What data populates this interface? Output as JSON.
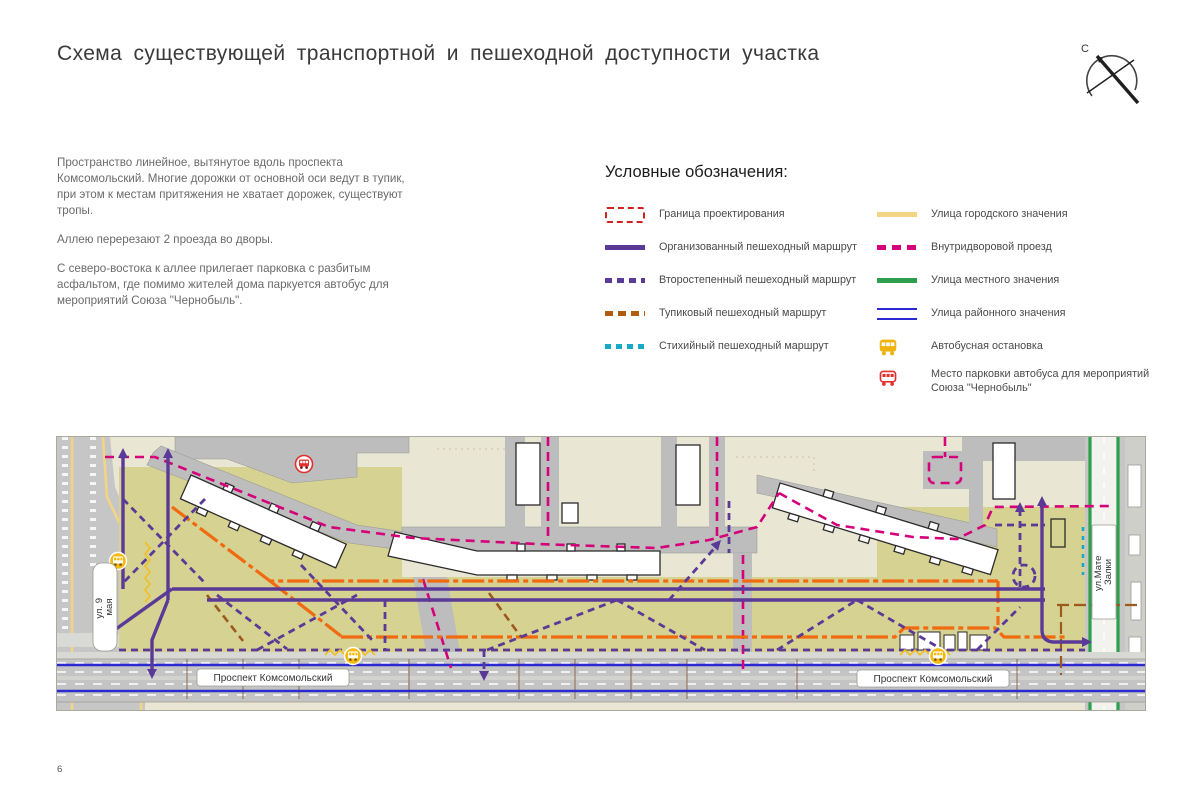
{
  "page": {
    "title": "Схема существующей  транспортной  и пешеходной доступности  участка",
    "page_number": "6",
    "compass_north": "С"
  },
  "description": {
    "paragraphs": [
      "Пространство линейное,  вытянутое вдоль проспекта Комсомольский. Многие дорожки от основной оси ведут в тупик, при этом к местам притяжения  не хватает дорожек, существуют тропы.",
      "Аллею перерезают 2 проезда во дворы.",
      "С северо-востока к аллее прилегает  парковка  с разбитым асфальтом, где помимо  жителей дома паркуется автобус для мероприятий Союза \"Чернобыль\"."
    ]
  },
  "legend": {
    "title": "Условные обозначения:",
    "left_items": [
      {
        "label": "Граница проектирования",
        "color": "#cc2222"
      },
      {
        "label": "Организованный  пешеходный маршрут",
        "color": "#5a3a96"
      },
      {
        "label": "Второстепенный пешеходный маршрут",
        "color": "#5a3a96"
      },
      {
        "label": "Тупиковый пешеходный  маршрут",
        "color": "#b05c10"
      },
      {
        "label": "Стихийный  пешеходный  маршрут",
        "color": "#18a8c8"
      }
    ],
    "right_items": [
      {
        "label": "Улица городского значения",
        "color": "#f2d584"
      },
      {
        "label": "Внутридворовой проезд",
        "color": "#d6007a"
      },
      {
        "label": "Улица местного значения",
        "color": "#2e9e4f"
      },
      {
        "label": "Улица районного значения",
        "color": "#2a2ad0"
      },
      {
        "label": "Автобусная остановка",
        "color": "#f0b411"
      },
      {
        "label": "Место парковки автобуса  для мероприятий Союза \"Чернобыль\"",
        "color": "#e03030"
      }
    ]
  },
  "map": {
    "labels": {
      "street_left_line1": "ул. 9",
      "street_left_line2": "мая",
      "street_right_line1": "ул.Мате",
      "street_right_line2": "Залки",
      "avenue_left": "Проспект  Комсомольский",
      "avenue_right": "Проспект  Комсомольский"
    },
    "colors": {
      "yard": "#e9e6d4",
      "boulevard": "#d6d292",
      "paving": "#bdbdbd",
      "road": "#c4c4c4",
      "route_organized": "#5a3a96",
      "route_deadend_orange": "#f06a10",
      "driveway_magenta": "#d6007a",
      "street_city_yellow": "#f2d584",
      "street_local_green": "#2e9e4f",
      "street_district_blue": "#2a2ad0",
      "spontaneous_cyan": "#18a8c8",
      "bus_stop_yellow": "#f5b90f",
      "bus_parking_red": "#e03030"
    }
  }
}
